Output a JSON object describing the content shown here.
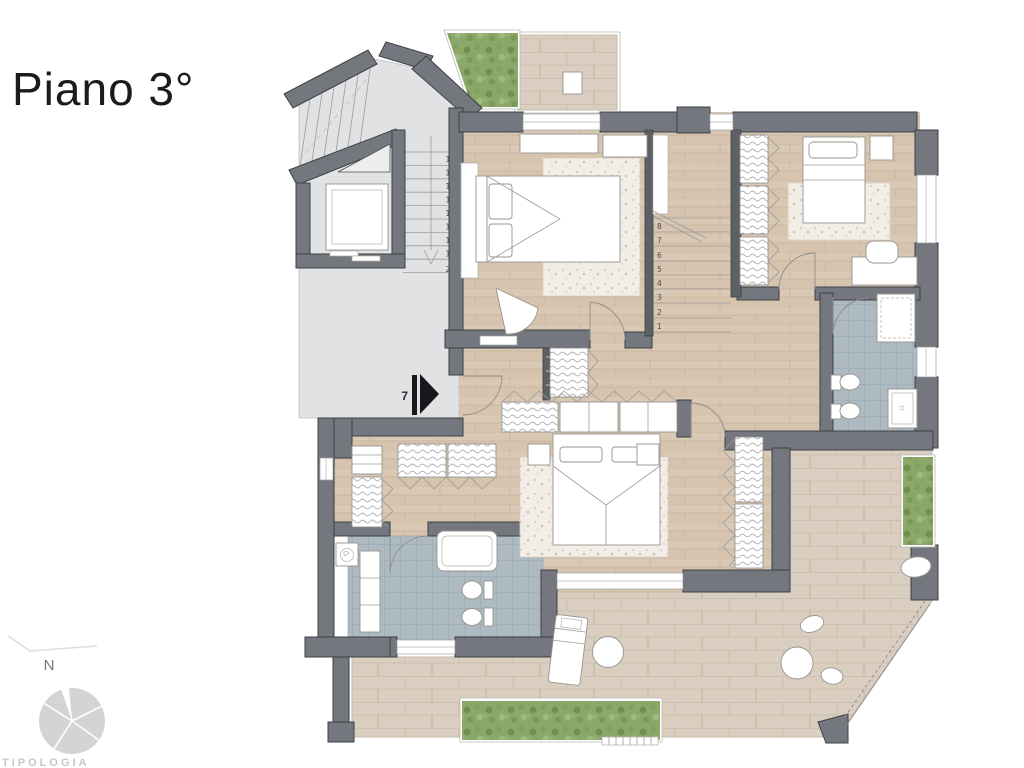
{
  "page": {
    "title": "Piano 3°",
    "watermark": "TIPOLOGIA"
  },
  "compass": {
    "north_label": "N"
  },
  "plan": {
    "entrance_marker": "7",
    "main_stairs": {
      "steps": [
        "12",
        "13",
        "14",
        "15",
        "16",
        "17",
        "18",
        "19",
        "20"
      ]
    },
    "inner_stairs": {
      "steps": [
        "8",
        "7",
        "6",
        "5",
        "4",
        "3",
        "2",
        "1"
      ]
    },
    "colors": {
      "wall": "#74787e",
      "wall_outline": "#3d4045",
      "landing_floor": "#e0e2e4",
      "wood_floor": "#d9c8b3",
      "bath_tile": "#adbac1",
      "terrace_paver": "#d9cec0",
      "hedge_green": "#8ba769",
      "furniture": "#ffffff",
      "entrance_arrow": "#17181b"
    }
  }
}
